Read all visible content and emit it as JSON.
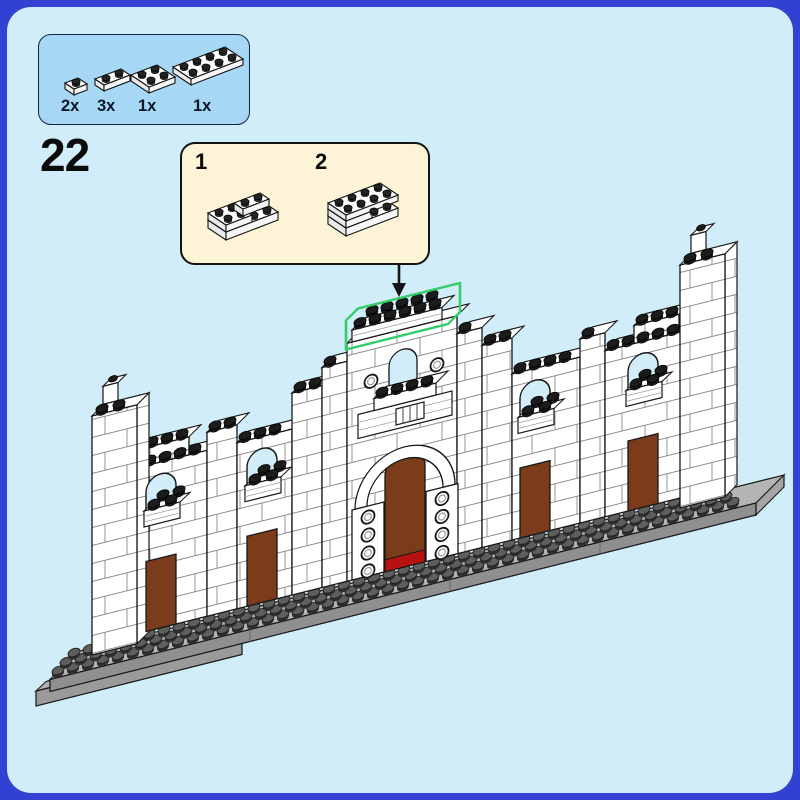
{
  "page": {
    "step_number": "22"
  },
  "parts_callout": {
    "items": [
      {
        "part": "plate-1x1",
        "qty_label": "2x"
      },
      {
        "part": "plate-1x2",
        "qty_label": "3x"
      },
      {
        "part": "plate-2x2",
        "qty_label": "1x"
      },
      {
        "part": "plate-2x4",
        "qty_label": "1x"
      }
    ]
  },
  "subassembly": {
    "steps": [
      {
        "label": "1"
      },
      {
        "label": "2"
      }
    ]
  },
  "palette": {
    "page_border_blue": "#3340d4",
    "page_bg": "#d1edf9",
    "callout_bg": "#a6d8f5",
    "subbox_bg": "#fdf3d7",
    "outline": "#161616",
    "wall_white": "#ffffff",
    "brick_line": "#8a8a8a",
    "plate_gray": "#8f8f8f",
    "plate_top_gray": "#b5b5b5",
    "plate_stud_gray": "#5e5e5e",
    "stud_black": "#1c1c1c",
    "door_brown": "#7a3c1b",
    "sill_red": "#b51210",
    "highlight_green": "#35cc6b"
  }
}
